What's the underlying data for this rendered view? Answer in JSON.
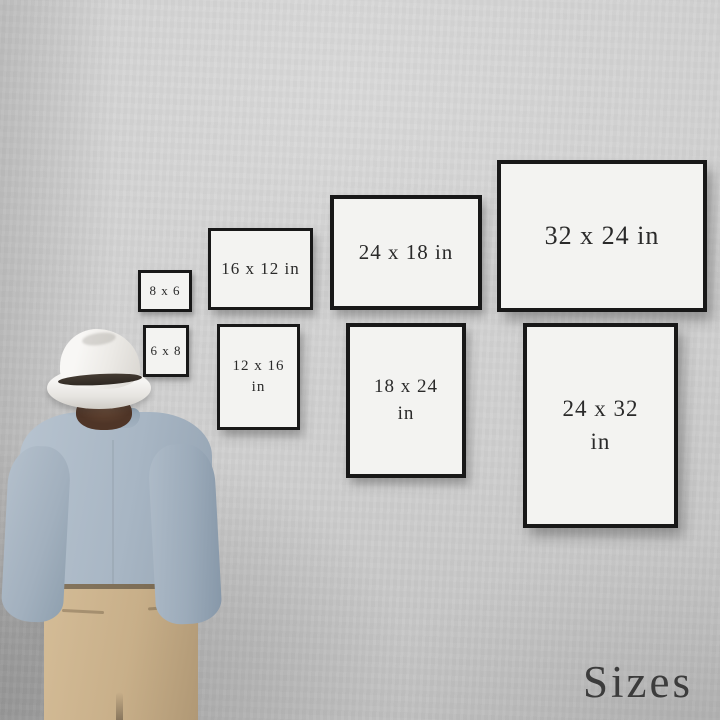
{
  "watermark": {
    "label": "Sizes",
    "color": "#3c3c3c"
  },
  "frames": [
    {
      "name": "8x6",
      "line1": "8 x 6",
      "line2": ""
    },
    {
      "name": "16x12",
      "line1": "16 x 12 in",
      "line2": ""
    },
    {
      "name": "24x18",
      "line1": "24 x 18 in",
      "line2": ""
    },
    {
      "name": "32x24",
      "line1": "32 x 24 in",
      "line2": ""
    },
    {
      "name": "6x8",
      "line1": "6 x 8",
      "line2": ""
    },
    {
      "name": "12x16",
      "line1": "12 x 16",
      "line2": "in"
    },
    {
      "name": "18x24",
      "line1": "18 x 24",
      "line2": "in"
    },
    {
      "name": "24x32",
      "line1": "24 x 32",
      "line2": "in"
    }
  ],
  "palette": {
    "wall": "#cccccc",
    "frame_border": "#181818",
    "frame_face": "#f3f3f1",
    "label_text": "#2a2a2a",
    "hat": "#f2f1ef",
    "hat_band": "#352e27",
    "hair": "#5a3d2d",
    "shirt": "#a8b6c4",
    "pants": "#c8af89"
  }
}
